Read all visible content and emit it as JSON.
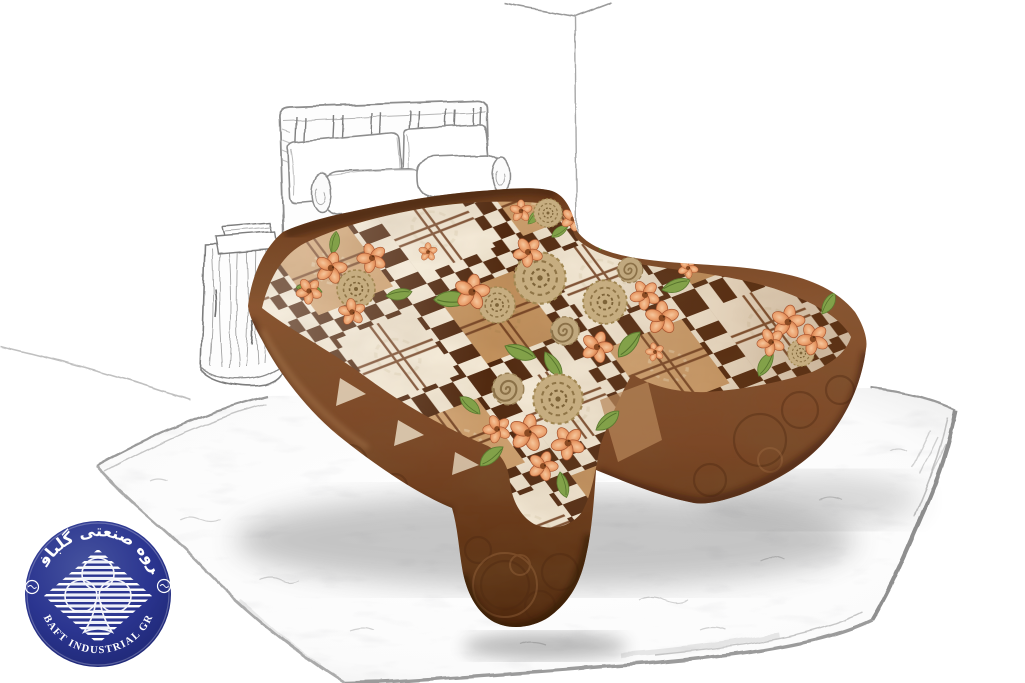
{
  "scene": {
    "type": "blanket-product-showcase",
    "background_color": "#ffffff",
    "objects": [
      "room-corner-sketch",
      "headboard-sketch",
      "flat-pillows-sketch",
      "bolster-pillows-sketch",
      "wooden-stool-sketch",
      "double-bed-blanket",
      "fluffy-white-rug",
      "brand-seal-logo"
    ]
  },
  "logo": {
    "shape": "circular-seal",
    "top_text": "گروه صنعتی گلبافت",
    "bottom_text": "GOLBAFT INDUSTRIAL GROUP",
    "disc_color": "#2b3590",
    "text_color": "#ffffff",
    "emblem": "striped-clover-flower"
  },
  "blanket": {
    "pattern": "argyle diamond lattice with floral bouquets",
    "colors": {
      "cream": "#f2e7d3",
      "tan_light": "#cd9f6d",
      "tan_dark": "#c1905c",
      "check_brown": "#50280f",
      "side_brown": "#7c4827",
      "accent_line": "#6f3d1e",
      "flower_orange": "#e89a66",
      "leaf_green": "#82a149",
      "rose_beige": "#c0a87e"
    }
  },
  "sketch": {
    "line_color": "#8d8d8d",
    "rug_color": "#ffffff"
  }
}
